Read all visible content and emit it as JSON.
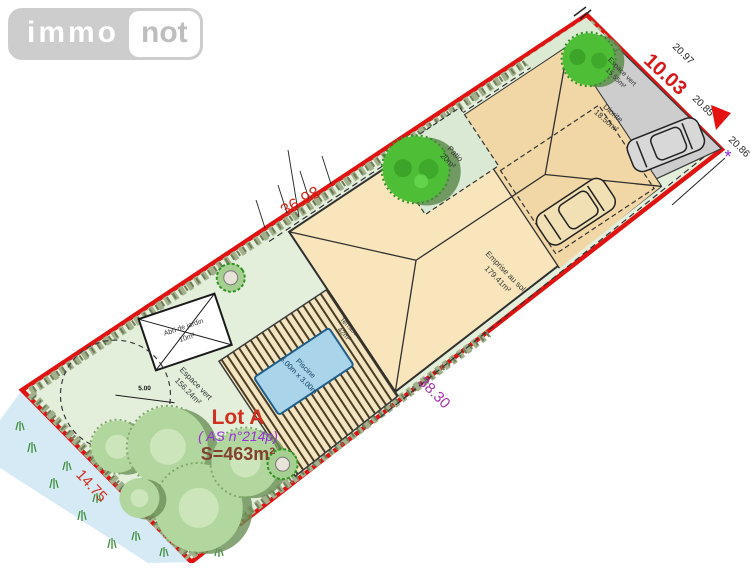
{
  "logo": {
    "immo": "immo",
    "not": "not"
  },
  "lot": {
    "name": "Lot A",
    "parcel_ref": "( AS n°214p)",
    "surface": "S=463m²"
  },
  "dimensions": {
    "side_top_left": "36.98",
    "side_bottom_left": "14.75",
    "side_top_right": "10.03",
    "side_bottom_right": "38.30",
    "neighbor_top": "20.97",
    "neighbor_mid": "20.85",
    "neighbor_right": "20.86",
    "tree_circle_radius": "5.00",
    "corner_marker": "*"
  },
  "features": {
    "house": {
      "label": "Emprise au sol",
      "area": "179.41m²"
    },
    "patio": {
      "label": "Patio",
      "area": "20m²"
    },
    "terrace": {
      "label": "Terrasse",
      "area": "42m²"
    },
    "pool": {
      "label": "Piscine",
      "size": "6.00m x 3.00m"
    },
    "shed": {
      "label": "Abri de jardin",
      "area": "10m²"
    },
    "green_main": {
      "label": "Espace vert",
      "area": "156.24m²"
    },
    "green_ne": {
      "label": "Espace vert",
      "area": "15.55m²"
    },
    "driveway": {
      "label": "Diorite",
      "area": "18.50m²"
    }
  },
  "colors": {
    "boundary": "#e01212",
    "dimension_red": "#d03020",
    "dimension_purple": "#a335a8",
    "lot_ref_purple": "#9b30d6",
    "surface_maroon": "#83402f",
    "parcel_green": "#e3efdb",
    "house_beige": "#f8e5bb",
    "pool_blue": "#a9d4e9",
    "driveway_gray": "#cdcdcd"
  }
}
